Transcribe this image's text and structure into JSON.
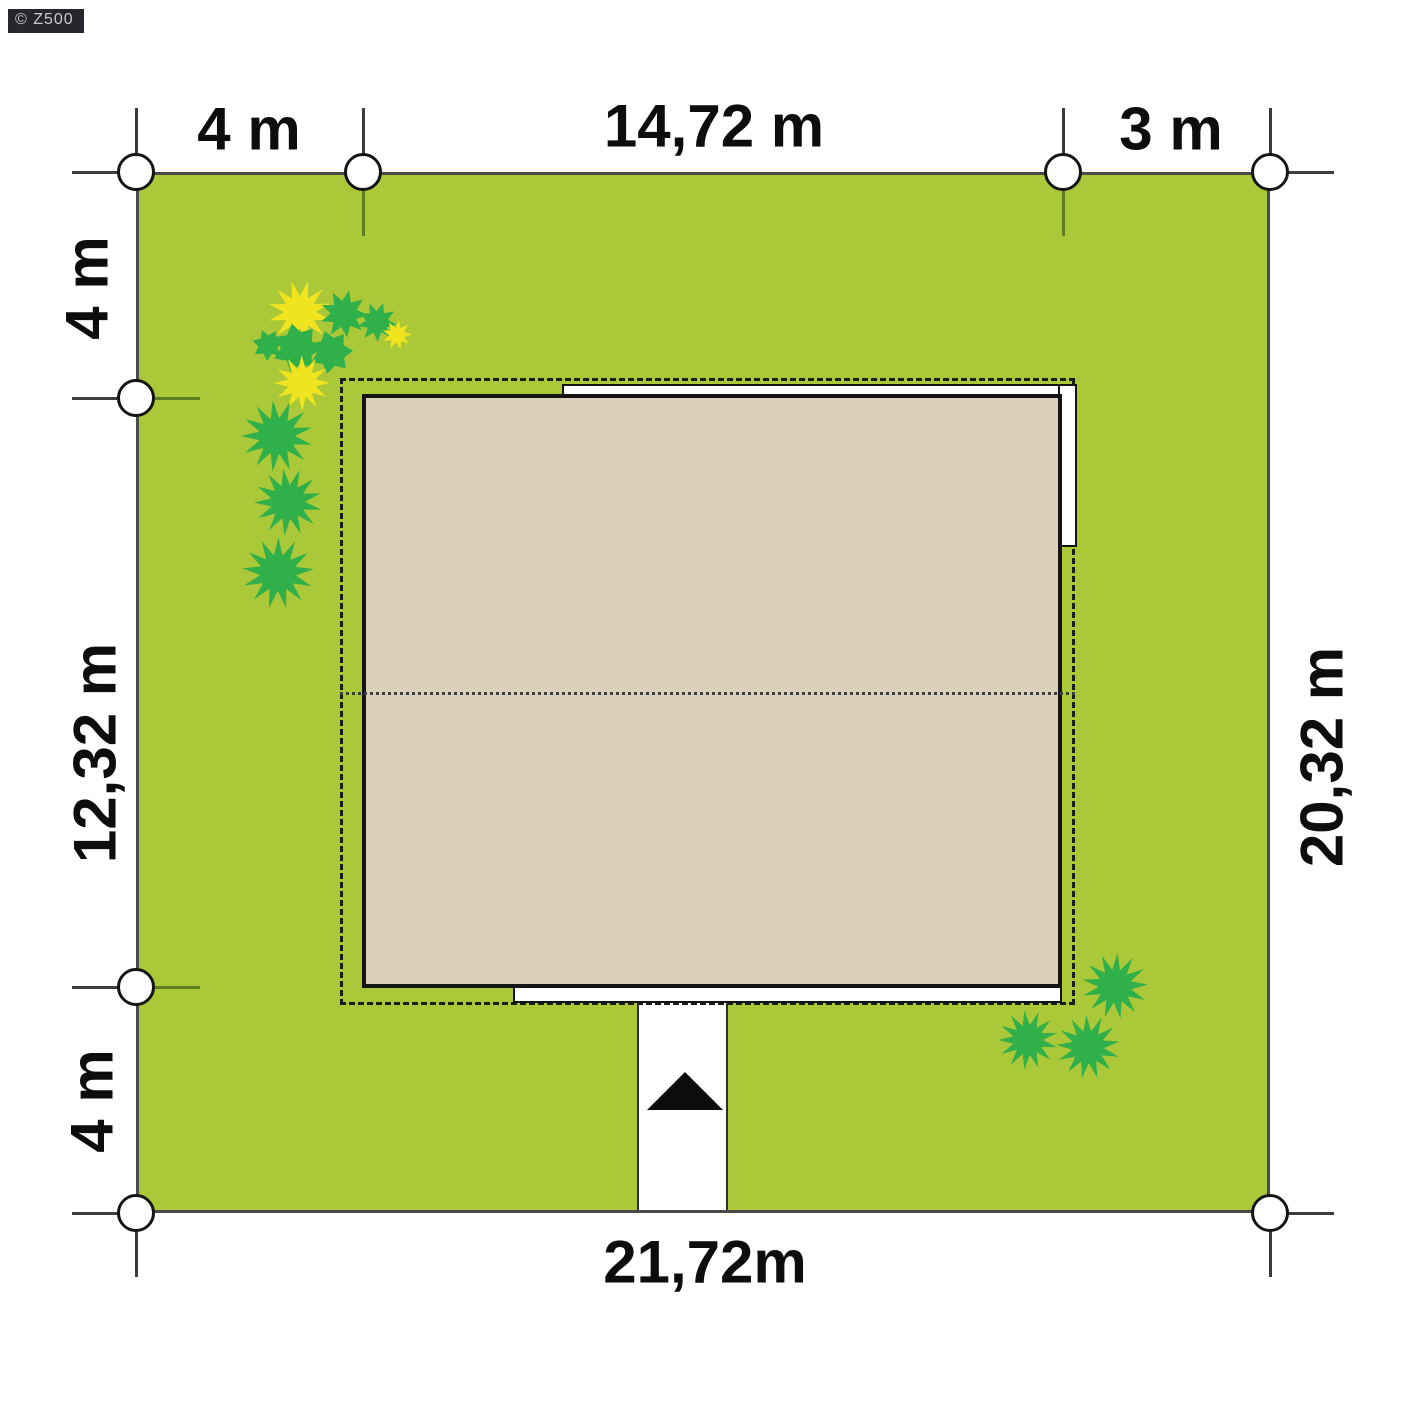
{
  "watermark": {
    "label": "© Z500"
  },
  "dimensions": {
    "top_left": "4 m",
    "top_middle": "14,72 m",
    "top_right": "3 m",
    "left_top": "4 m",
    "left_middle": "12,32 m",
    "left_bottom": "4 m",
    "right_side": "20,32 m",
    "bottom": "21,72m"
  },
  "colors": {
    "grass": "#abc838",
    "roof": "#dcd0bd",
    "bush_green": "#2fb04a",
    "bush_yellow": "#f0e41f",
    "outline": "#141414",
    "tick_outer": "#3c3c3c",
    "tick_inner": "#5d7d20",
    "marker_fill": "#ffffff"
  },
  "markers": [
    {
      "x": 136,
      "y": 172,
      "ticks": [
        "up",
        "left"
      ]
    },
    {
      "x": 363,
      "y": 172,
      "ticks": [
        "up",
        "down-in"
      ]
    },
    {
      "x": 1063,
      "y": 172,
      "ticks": [
        "up",
        "down-in"
      ]
    },
    {
      "x": 1270,
      "y": 172,
      "ticks": [
        "up",
        "right"
      ]
    },
    {
      "x": 136,
      "y": 398,
      "ticks": [
        "left",
        "right-in"
      ]
    },
    {
      "x": 136,
      "y": 987,
      "ticks": [
        "left",
        "right-in"
      ]
    },
    {
      "x": 136,
      "y": 1213,
      "ticks": [
        "left",
        "down"
      ]
    },
    {
      "x": 1270,
      "y": 1213,
      "ticks": [
        "right",
        "down"
      ]
    }
  ],
  "plants": [
    {
      "x": 300,
      "y": 312,
      "r": 32,
      "n": 12,
      "inner": 0.5,
      "c": "yellow"
    },
    {
      "x": 344,
      "y": 314,
      "r": 24,
      "n": 9,
      "inner": 0.55,
      "c": "green"
    },
    {
      "x": 377,
      "y": 322,
      "r": 20,
      "n": 9,
      "inner": 0.55,
      "c": "green"
    },
    {
      "x": 397,
      "y": 335,
      "r": 15,
      "n": 9,
      "inner": 0.5,
      "c": "yellow"
    },
    {
      "x": 297,
      "y": 348,
      "r": 25,
      "n": 7,
      "inner": 0.65,
      "c": "green"
    },
    {
      "x": 331,
      "y": 352,
      "r": 22,
      "n": 7,
      "inner": 0.65,
      "c": "green"
    },
    {
      "x": 268,
      "y": 345,
      "r": 16,
      "n": 7,
      "inner": 0.6,
      "c": "green"
    },
    {
      "x": 302,
      "y": 383,
      "r": 28,
      "n": 12,
      "inner": 0.5,
      "c": "yellow"
    },
    {
      "x": 277,
      "y": 436,
      "r": 36,
      "n": 13,
      "inner": 0.5,
      "c": "green"
    },
    {
      "x": 288,
      "y": 502,
      "r": 34,
      "n": 13,
      "inner": 0.5,
      "c": "green"
    },
    {
      "x": 278,
      "y": 573,
      "r": 36,
      "n": 13,
      "inner": 0.5,
      "c": "green"
    },
    {
      "x": 1115,
      "y": 986,
      "r": 33,
      "n": 13,
      "inner": 0.5,
      "c": "green"
    },
    {
      "x": 1028,
      "y": 1040,
      "r": 30,
      "n": 13,
      "inner": 0.5,
      "c": "green"
    },
    {
      "x": 1088,
      "y": 1047,
      "r": 32,
      "n": 13,
      "inner": 0.5,
      "c": "green"
    }
  ]
}
